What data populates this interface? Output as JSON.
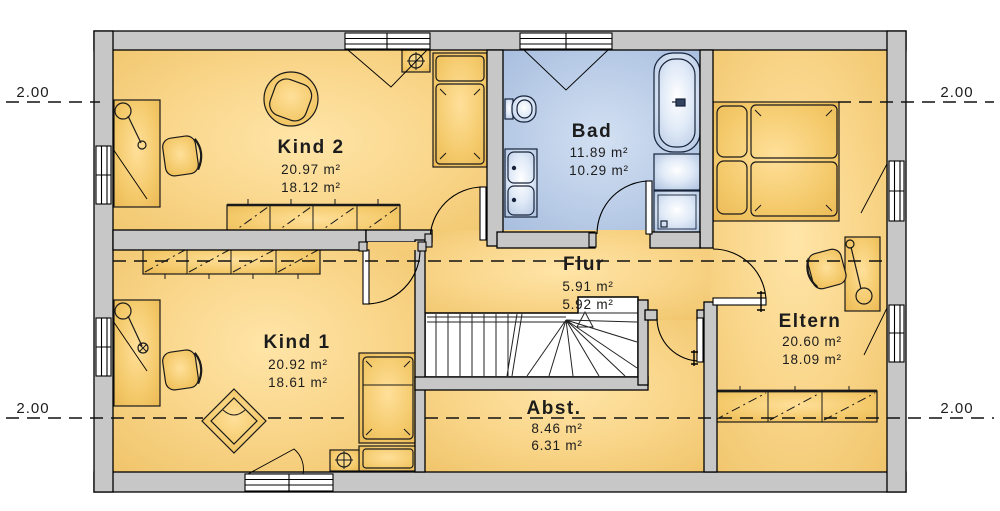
{
  "plan": {
    "type": "floor-plan-upper-storey",
    "rooms": {
      "kind2": {
        "name": "Kind 2",
        "area_gross": "20.97 m²",
        "area_net": "18.12 m²"
      },
      "bad": {
        "name": "Bad",
        "area_gross": "11.89 m²",
        "area_net": "10.29 m²"
      },
      "eltern": {
        "name": "Eltern",
        "area_gross": "20.60 m²",
        "area_net": "18.09 m²"
      },
      "kind1": {
        "name": "Kind 1",
        "area_gross": "20.92 m²",
        "area_net": "18.61 m²"
      },
      "flur": {
        "name": "Flur",
        "area_gross": "5.91 m²",
        "area_net": "5.92 m²"
      },
      "abstellraum": {
        "name": "Abst.",
        "area_gross": "8.46 m²",
        "area_net": "6.31 m²"
      }
    },
    "dimension_marks": {
      "top_left": "2.00",
      "top_right": "2.00",
      "bottom_left": "2.00",
      "bottom_right": "2.00"
    },
    "colors": {
      "room_fill": "#f8d385",
      "bath_fill": "#b3c7e4",
      "wall_fill": "#c7c7c7",
      "outline": "#000000",
      "background": "#ffffff"
    },
    "symbols": {
      "heating_valve": "⊕",
      "stairs_up_arrow": "△"
    }
  }
}
